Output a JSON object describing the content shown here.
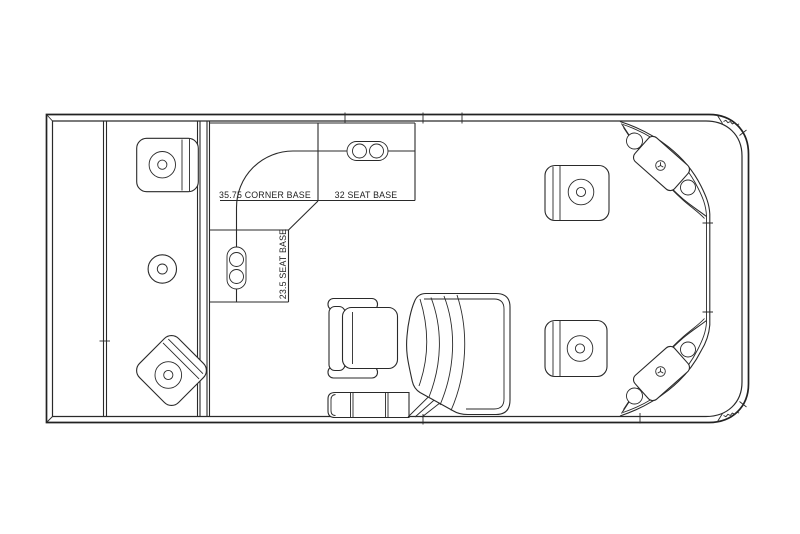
{
  "drawing": {
    "background_color": "#ffffff",
    "line_color": "#2a2a2a",
    "labels": {
      "corner_base": "35.75 CORNER BASE",
      "seat_base_32": "32 SEAT BASE",
      "seat_base_23_5": "23.5 SEAT BASE"
    }
  }
}
